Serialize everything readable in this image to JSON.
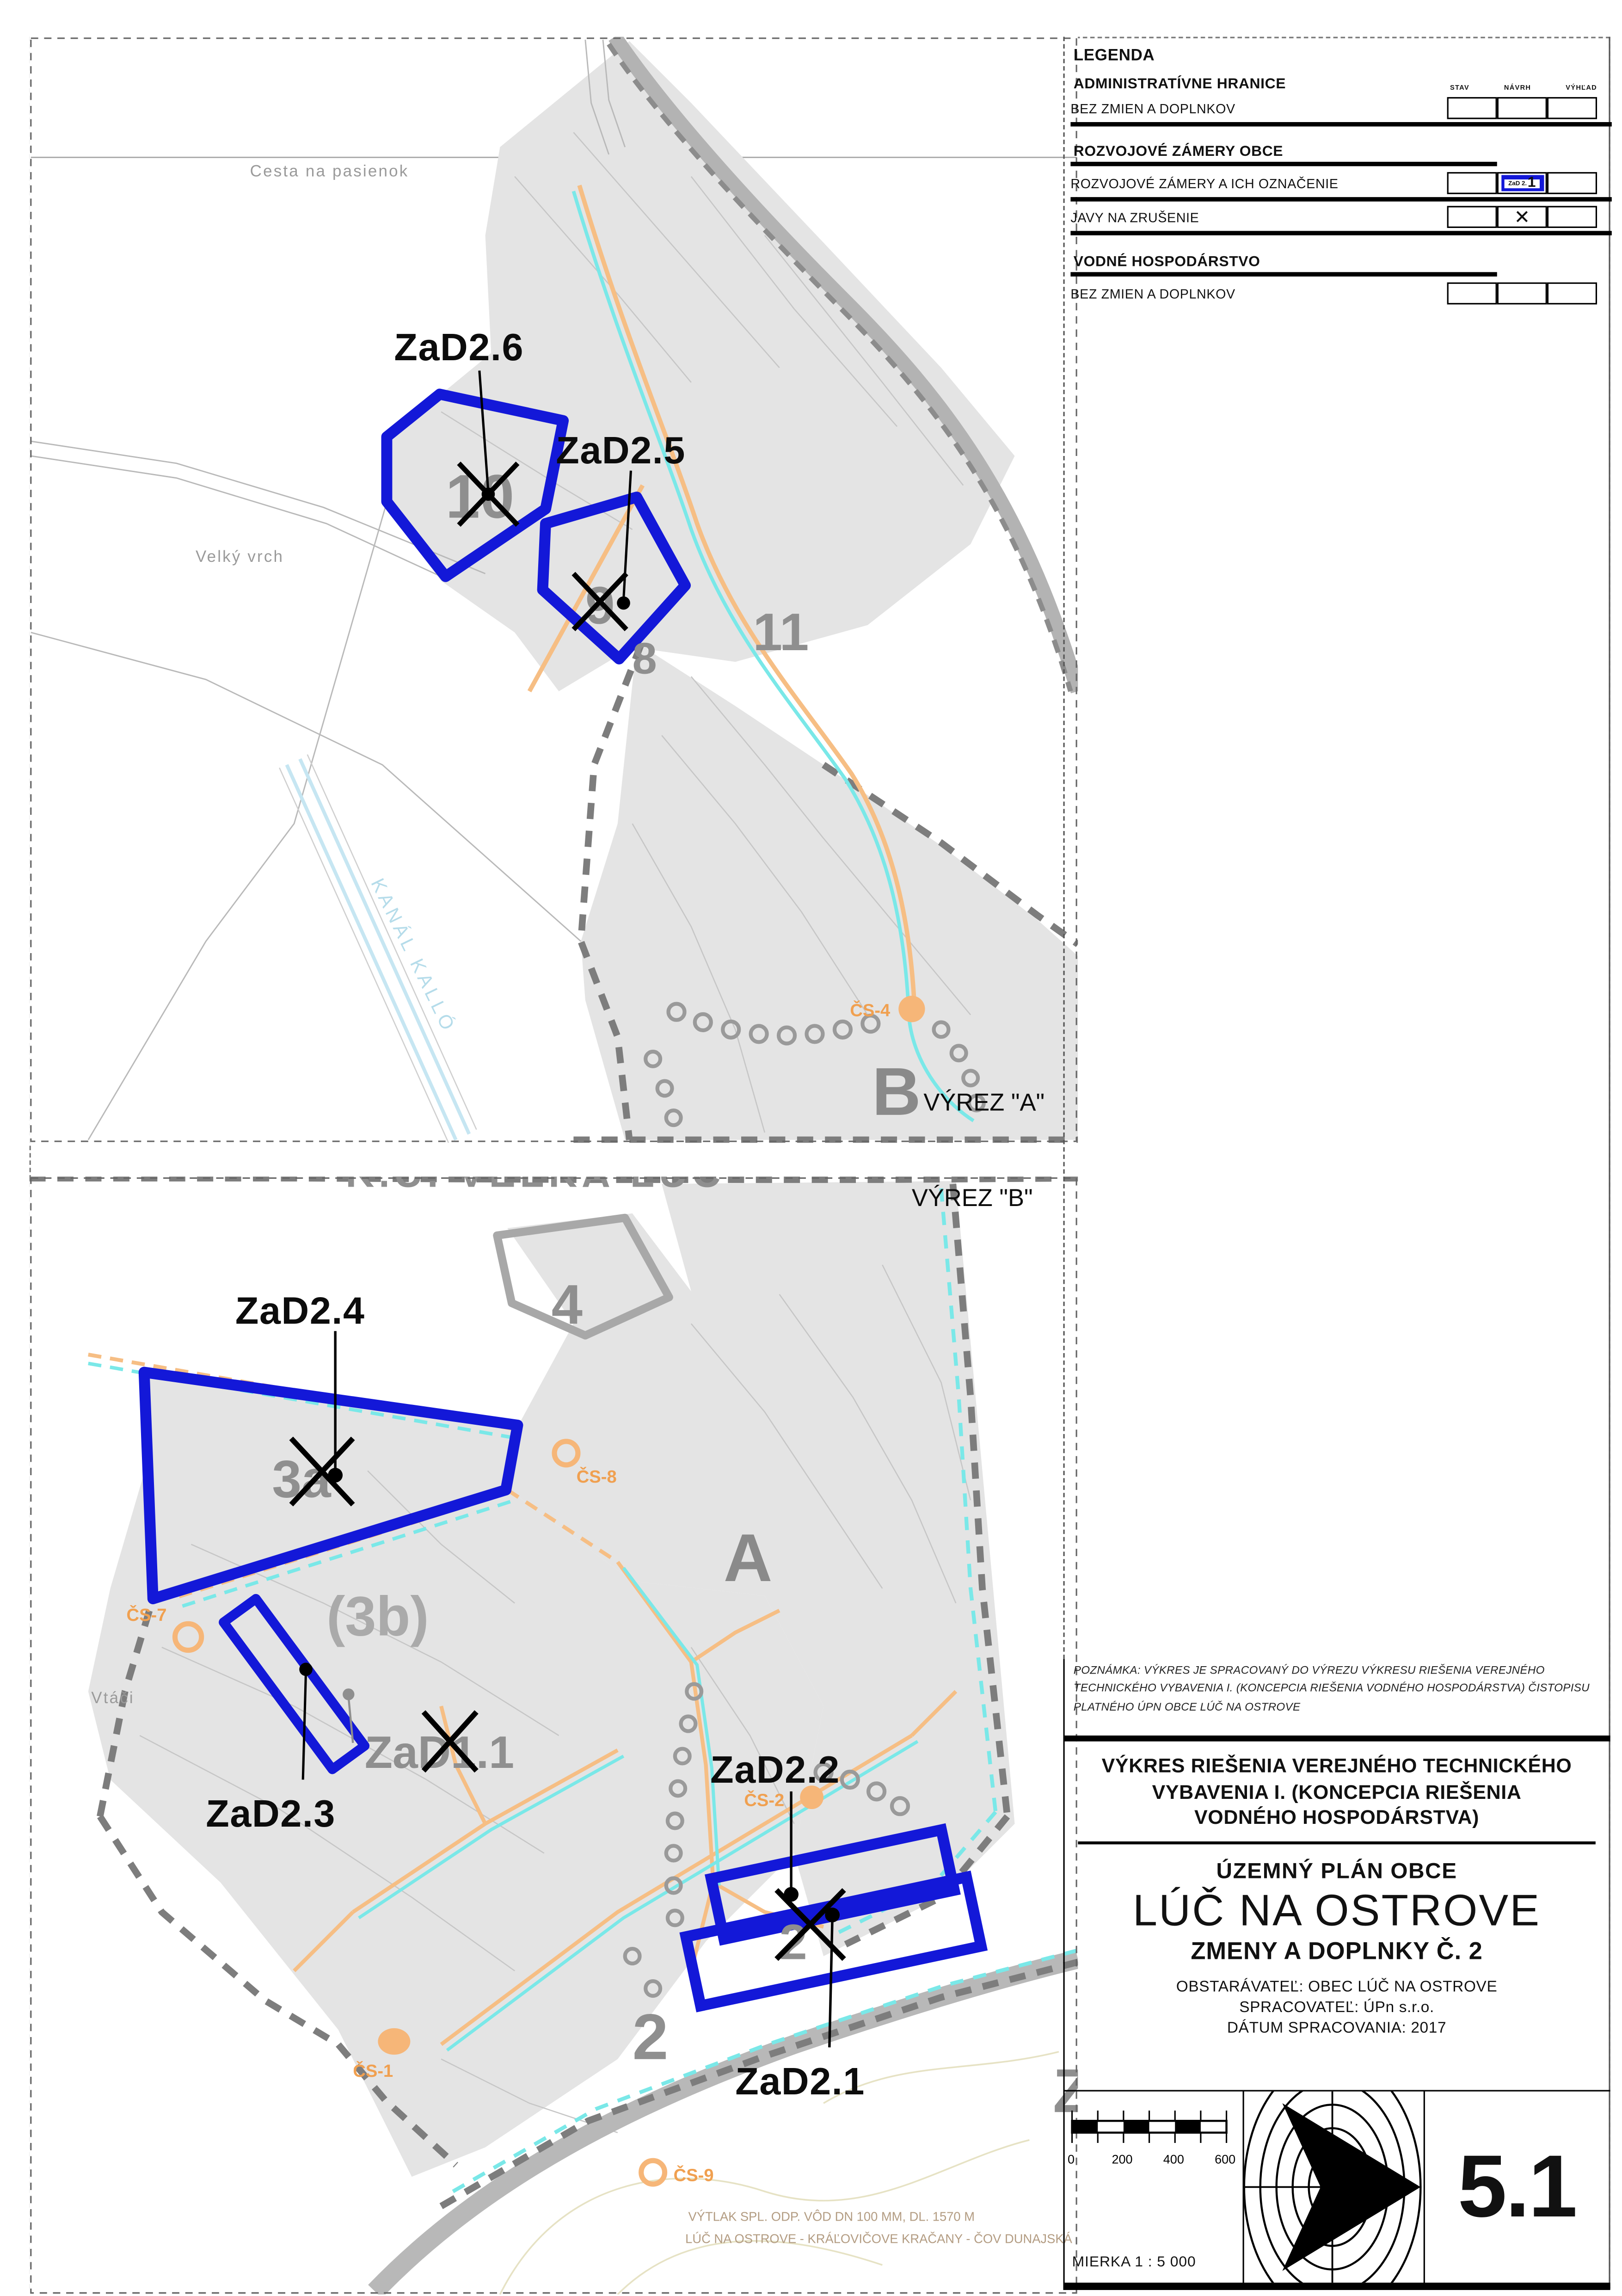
{
  "panel_a": {
    "vyrez_label": "VÝREZ \"A\"",
    "road_top_label": "Cesta na pasienok",
    "hill_label": "Velký vrch",
    "canal_label": "KANÁL KALLÓ",
    "big_letter": "B",
    "zone_8": "8",
    "zone_9": "9",
    "zone_10": "10",
    "zone_11": "11",
    "zad_6": "ZaD2.6",
    "zad_5": "ZaD2.5",
    "cs_4": "ČS-4"
  },
  "panel_b": {
    "vyrez_label": "VÝREZ \"B\"",
    "cadastre_label": "K.Ú. VEĽKÁ LÚČ",
    "zone_4": "4",
    "zone_3a": "3a",
    "zone_3b": "(3b)",
    "zone_a": "A",
    "zone_2": "2",
    "partial_letter": "Z",
    "zad_4": "ZaD2.4",
    "zad_3": "ZaD2.3",
    "zad_2": "ZaD2.2",
    "zad_1": "ZaD2.1",
    "old_zad_label": "ZaD1.1",
    "vtaci_label": "Vtáči",
    "cs_7": "ČS-7",
    "cs_8": "ČS-8",
    "cs_2": "ČS-2",
    "cs_1": "ČS-1",
    "cs_9": "ČS-9",
    "pipeline_note_line1": "VÝTLAK SPL. ODP. VÔD DN 100 MM, DL. 1570 M",
    "pipeline_note_line2": "LÚČ NA OSTROVE - KRÁĽOVIČOVE KRAČANY  - ČOV DUNAJSKÁ"
  },
  "legend": {
    "title": "LEGENDA",
    "col_stav": "STAV",
    "col_navrh": "NÁVRH",
    "col_vyhlad": "VÝHĽAD",
    "sec1_heading": "ADMINISTRATÍVNE HRANICE",
    "sec1_row1": "BEZ ZMIEN A DOPLNKOV",
    "sec2_heading": "ROZVOJOVÉ ZÁMERY OBCE",
    "sec2_row1": "ROZVOJOVÉ ZÁMERY A ICH OZNAČENIE",
    "sec2_row1_symbol_small": "ZaD 2.",
    "sec2_row1_symbol_big": "1",
    "sec2_row2": "JAVY NA ZRUŠENIE",
    "sec2_row2_symbol": "✕",
    "sec3_heading": "VODNÉ HOSPODÁRSTVO",
    "sec3_row1": "BEZ ZMIEN A DOPLNKOV"
  },
  "note": {
    "line1": "POZNÁMKA: VÝKRES  JE SPRACOVANÝ DO VÝREZU VÝKRESU RIEŠENIA VEREJNÉHO",
    "line2": "TECHNICKÉHO VYBAVENIA I. (KONCEPCIA RIEŠENIA VODNÉHO HOSPODÁRSTVA) ČISTOPISU",
    "line3": "PLATNÉHO ÚPN OBCE LÚČ NA OSTROVE"
  },
  "title_block": {
    "drawing_title_line1": "VÝKRES RIEŠENIA VEREJNÉHO TECHNICKÉHO",
    "drawing_title_line2": "VYBAVENIA I. (KONCEPCIA RIEŠENIA",
    "drawing_title_line3": "VODNÉHO HOSPODÁRSTVA)",
    "doc_type": "ÚZEMNÝ PLÁN OBCE",
    "municipality": "LÚČ NA OSTROVE",
    "amendment": "ZMENY A DOPLNKY Č. 2",
    "client": "OBSTARÁVATEĽ: OBEC LÚČ NA OSTROVE",
    "author": "SPRACOVATEĽ: ÚPn s.r.o.",
    "date": "DÁTUM  SPRACOVANIA: 2017"
  },
  "footer": {
    "scale_ticks": [
      "0",
      "200",
      "400",
      "600"
    ],
    "scale_text": "MIERKA 1 : 5 000",
    "sheet_number": "5.1"
  },
  "colors": {
    "accent_blue": "#1318d8",
    "orange_line": "#f6be84",
    "cyan_line": "#7ae8e8",
    "map_grey": "#e4e4e4"
  }
}
